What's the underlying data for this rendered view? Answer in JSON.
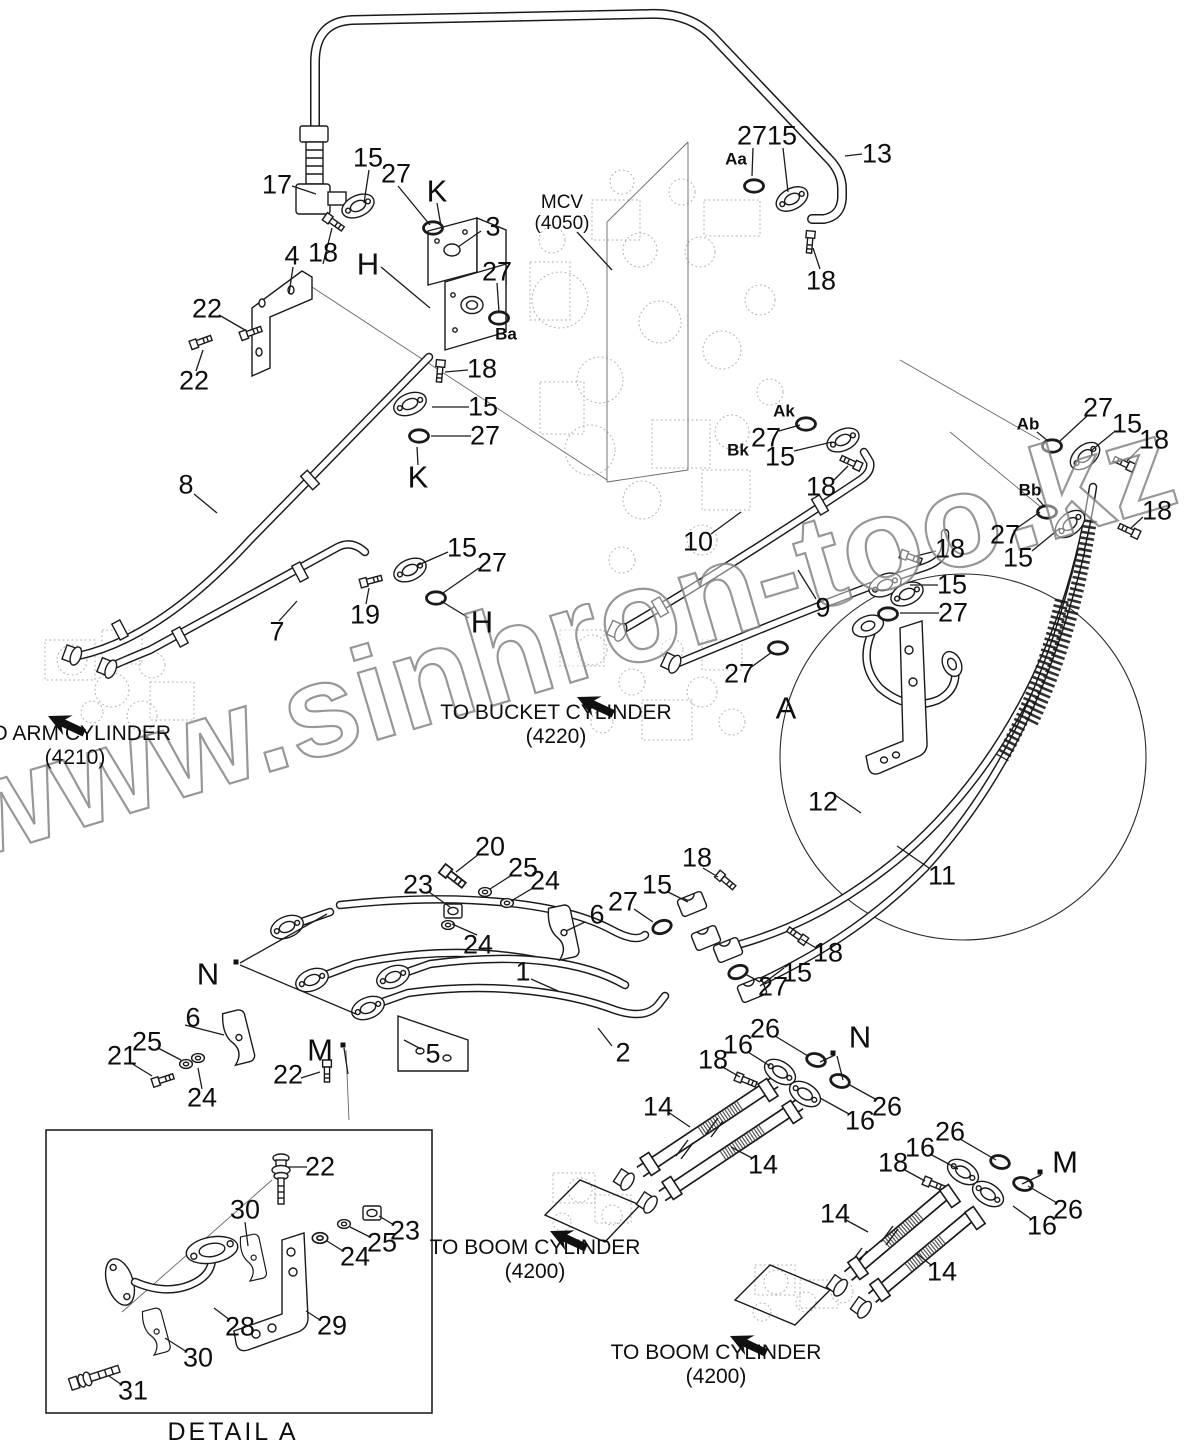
{
  "watermark": {
    "text": "www.sinhron-too.kz"
  },
  "detail": {
    "caption": "DETAIL  A"
  },
  "mcv": {
    "line1": "MCV",
    "line2": "(4050)"
  },
  "destinations": [
    {
      "line1": "TO ARM CYLINDER",
      "line2": "(4210)",
      "cx": 75,
      "y": 722
    },
    {
      "line1": "TO BUCKET CYLINDER",
      "line2": "(4220)",
      "cx": 556,
      "y": 701
    },
    {
      "line1": "TO BOOM CYLINDER",
      "line2": "(4200)",
      "cx": 535,
      "y": 1236
    },
    {
      "line1": "TO BOOM CYLINDER",
      "line2": "(4200)",
      "cx": 716,
      "y": 1341
    }
  ],
  "callouts": [
    {
      "t": "17",
      "x": 277,
      "y": 185
    },
    {
      "t": "15",
      "x": 368,
      "y": 158
    },
    {
      "t": "27",
      "x": 396,
      "y": 174
    },
    {
      "t": "K",
      "x": 437,
      "y": 191,
      "s": "l"
    },
    {
      "t": "3",
      "x": 493,
      "y": 227
    },
    {
      "t": "4",
      "x": 292,
      "y": 256
    },
    {
      "t": "18",
      "x": 323,
      "y": 253
    },
    {
      "t": "H",
      "x": 368,
      "y": 264,
      "s": "l"
    },
    {
      "t": "27",
      "x": 497,
      "y": 272
    },
    {
      "t": "22",
      "x": 207,
      "y": 309
    },
    {
      "t": "22",
      "x": 194,
      "y": 381
    },
    {
      "t": "Aa",
      "x": 736,
      "y": 159,
      "s": "p"
    },
    {
      "t": "27",
      "x": 752,
      "y": 136
    },
    {
      "t": "15",
      "x": 782,
      "y": 136
    },
    {
      "t": "13",
      "x": 877,
      "y": 154
    },
    {
      "t": "18",
      "x": 821,
      "y": 281
    },
    {
      "t": "Ba",
      "x": 506,
      "y": 334,
      "s": "p"
    },
    {
      "t": "18",
      "x": 482,
      "y": 369
    },
    {
      "t": "15",
      "x": 483,
      "y": 407
    },
    {
      "t": "27",
      "x": 485,
      "y": 436
    },
    {
      "t": "K",
      "x": 418,
      "y": 477,
      "s": "l"
    },
    {
      "t": "8",
      "x": 186,
      "y": 485
    },
    {
      "t": "Ak",
      "x": 784,
      "y": 411,
      "s": "p"
    },
    {
      "t": "27",
      "x": 766,
      "y": 438
    },
    {
      "t": "15",
      "x": 780,
      "y": 457
    },
    {
      "t": "Bk",
      "x": 738,
      "y": 450,
      "s": "p"
    },
    {
      "t": "18",
      "x": 821,
      "y": 487
    },
    {
      "t": "Ab",
      "x": 1028,
      "y": 424,
      "s": "p"
    },
    {
      "t": "27",
      "x": 1098,
      "y": 408
    },
    {
      "t": "15",
      "x": 1127,
      "y": 424
    },
    {
      "t": "18",
      "x": 1154,
      "y": 440
    },
    {
      "t": "Bb",
      "x": 1030,
      "y": 490,
      "s": "p"
    },
    {
      "t": "27",
      "x": 1005,
      "y": 535
    },
    {
      "t": "15",
      "x": 1018,
      "y": 558
    },
    {
      "t": "18",
      "x": 1157,
      "y": 511
    },
    {
      "t": "10",
      "x": 698,
      "y": 542
    },
    {
      "t": "18",
      "x": 950,
      "y": 549
    },
    {
      "t": "15",
      "x": 952,
      "y": 585
    },
    {
      "t": "9",
      "x": 823,
      "y": 608
    },
    {
      "t": "27",
      "x": 953,
      "y": 613
    },
    {
      "t": "15",
      "x": 462,
      "y": 548
    },
    {
      "t": "27",
      "x": 492,
      "y": 563
    },
    {
      "t": "19",
      "x": 365,
      "y": 615
    },
    {
      "t": "H",
      "x": 482,
      "y": 622,
      "s": "l"
    },
    {
      "t": "7",
      "x": 277,
      "y": 632
    },
    {
      "t": "27",
      "x": 739,
      "y": 674
    },
    {
      "t": "A",
      "x": 786,
      "y": 708,
      "s": "l"
    },
    {
      "t": "12",
      "x": 823,
      "y": 802
    },
    {
      "t": "11",
      "x": 942,
      "y": 876
    },
    {
      "t": "20",
      "x": 490,
      "y": 847
    },
    {
      "t": "25",
      "x": 523,
      "y": 868
    },
    {
      "t": "24",
      "x": 545,
      "y": 881
    },
    {
      "t": "23",
      "x": 418,
      "y": 885
    },
    {
      "t": "6",
      "x": 597,
      "y": 915
    },
    {
      "t": "24",
      "x": 478,
      "y": 945
    },
    {
      "t": "N",
      "x": 208,
      "y": 974,
      "s": "l"
    },
    {
      "t": "1",
      "x": 523,
      "y": 972
    },
    {
      "t": "18",
      "x": 697,
      "y": 858
    },
    {
      "t": "15",
      "x": 657,
      "y": 885
    },
    {
      "t": "27",
      "x": 623,
      "y": 902
    },
    {
      "t": "18",
      "x": 828,
      "y": 953
    },
    {
      "t": "15",
      "x": 797,
      "y": 973
    },
    {
      "t": "27",
      "x": 773,
      "y": 987
    },
    {
      "t": "6",
      "x": 193,
      "y": 1018
    },
    {
      "t": "M",
      "x": 320,
      "y": 1050,
      "s": "l"
    },
    {
      "t": "5",
      "x": 433,
      "y": 1054
    },
    {
      "t": "2",
      "x": 623,
      "y": 1053
    },
    {
      "t": "22",
      "x": 288,
      "y": 1075
    },
    {
      "t": "21",
      "x": 122,
      "y": 1056
    },
    {
      "t": "25",
      "x": 147,
      "y": 1042
    },
    {
      "t": "24",
      "x": 202,
      "y": 1098
    },
    {
      "t": "26",
      "x": 765,
      "y": 1029
    },
    {
      "t": "16",
      "x": 738,
      "y": 1045
    },
    {
      "t": "18",
      "x": 713,
      "y": 1060
    },
    {
      "t": "N",
      "x": 860,
      "y": 1037,
      "s": "l"
    },
    {
      "t": "26",
      "x": 887,
      "y": 1107
    },
    {
      "t": "16",
      "x": 860,
      "y": 1121
    },
    {
      "t": "26",
      "x": 950,
      "y": 1132
    },
    {
      "t": "16",
      "x": 920,
      "y": 1148
    },
    {
      "t": "18",
      "x": 893,
      "y": 1163
    },
    {
      "t": "M",
      "x": 1065,
      "y": 1162,
      "s": "l"
    },
    {
      "t": "26",
      "x": 1068,
      "y": 1210
    },
    {
      "t": "16",
      "x": 1042,
      "y": 1226
    },
    {
      "t": "14",
      "x": 658,
      "y": 1107
    },
    {
      "t": "14",
      "x": 763,
      "y": 1165
    },
    {
      "t": "14",
      "x": 835,
      "y": 1214
    },
    {
      "t": "14",
      "x": 942,
      "y": 1272
    },
    {
      "t": "22",
      "x": 320,
      "y": 1167
    },
    {
      "t": "30",
      "x": 245,
      "y": 1210
    },
    {
      "t": "23",
      "x": 405,
      "y": 1231
    },
    {
      "t": "25",
      "x": 382,
      "y": 1243
    },
    {
      "t": "24",
      "x": 355,
      "y": 1257
    },
    {
      "t": "28",
      "x": 240,
      "y": 1327
    },
    {
      "t": "29",
      "x": 332,
      "y": 1326
    },
    {
      "t": "30",
      "x": 198,
      "y": 1358
    },
    {
      "t": "31",
      "x": 133,
      "y": 1391
    }
  ]
}
